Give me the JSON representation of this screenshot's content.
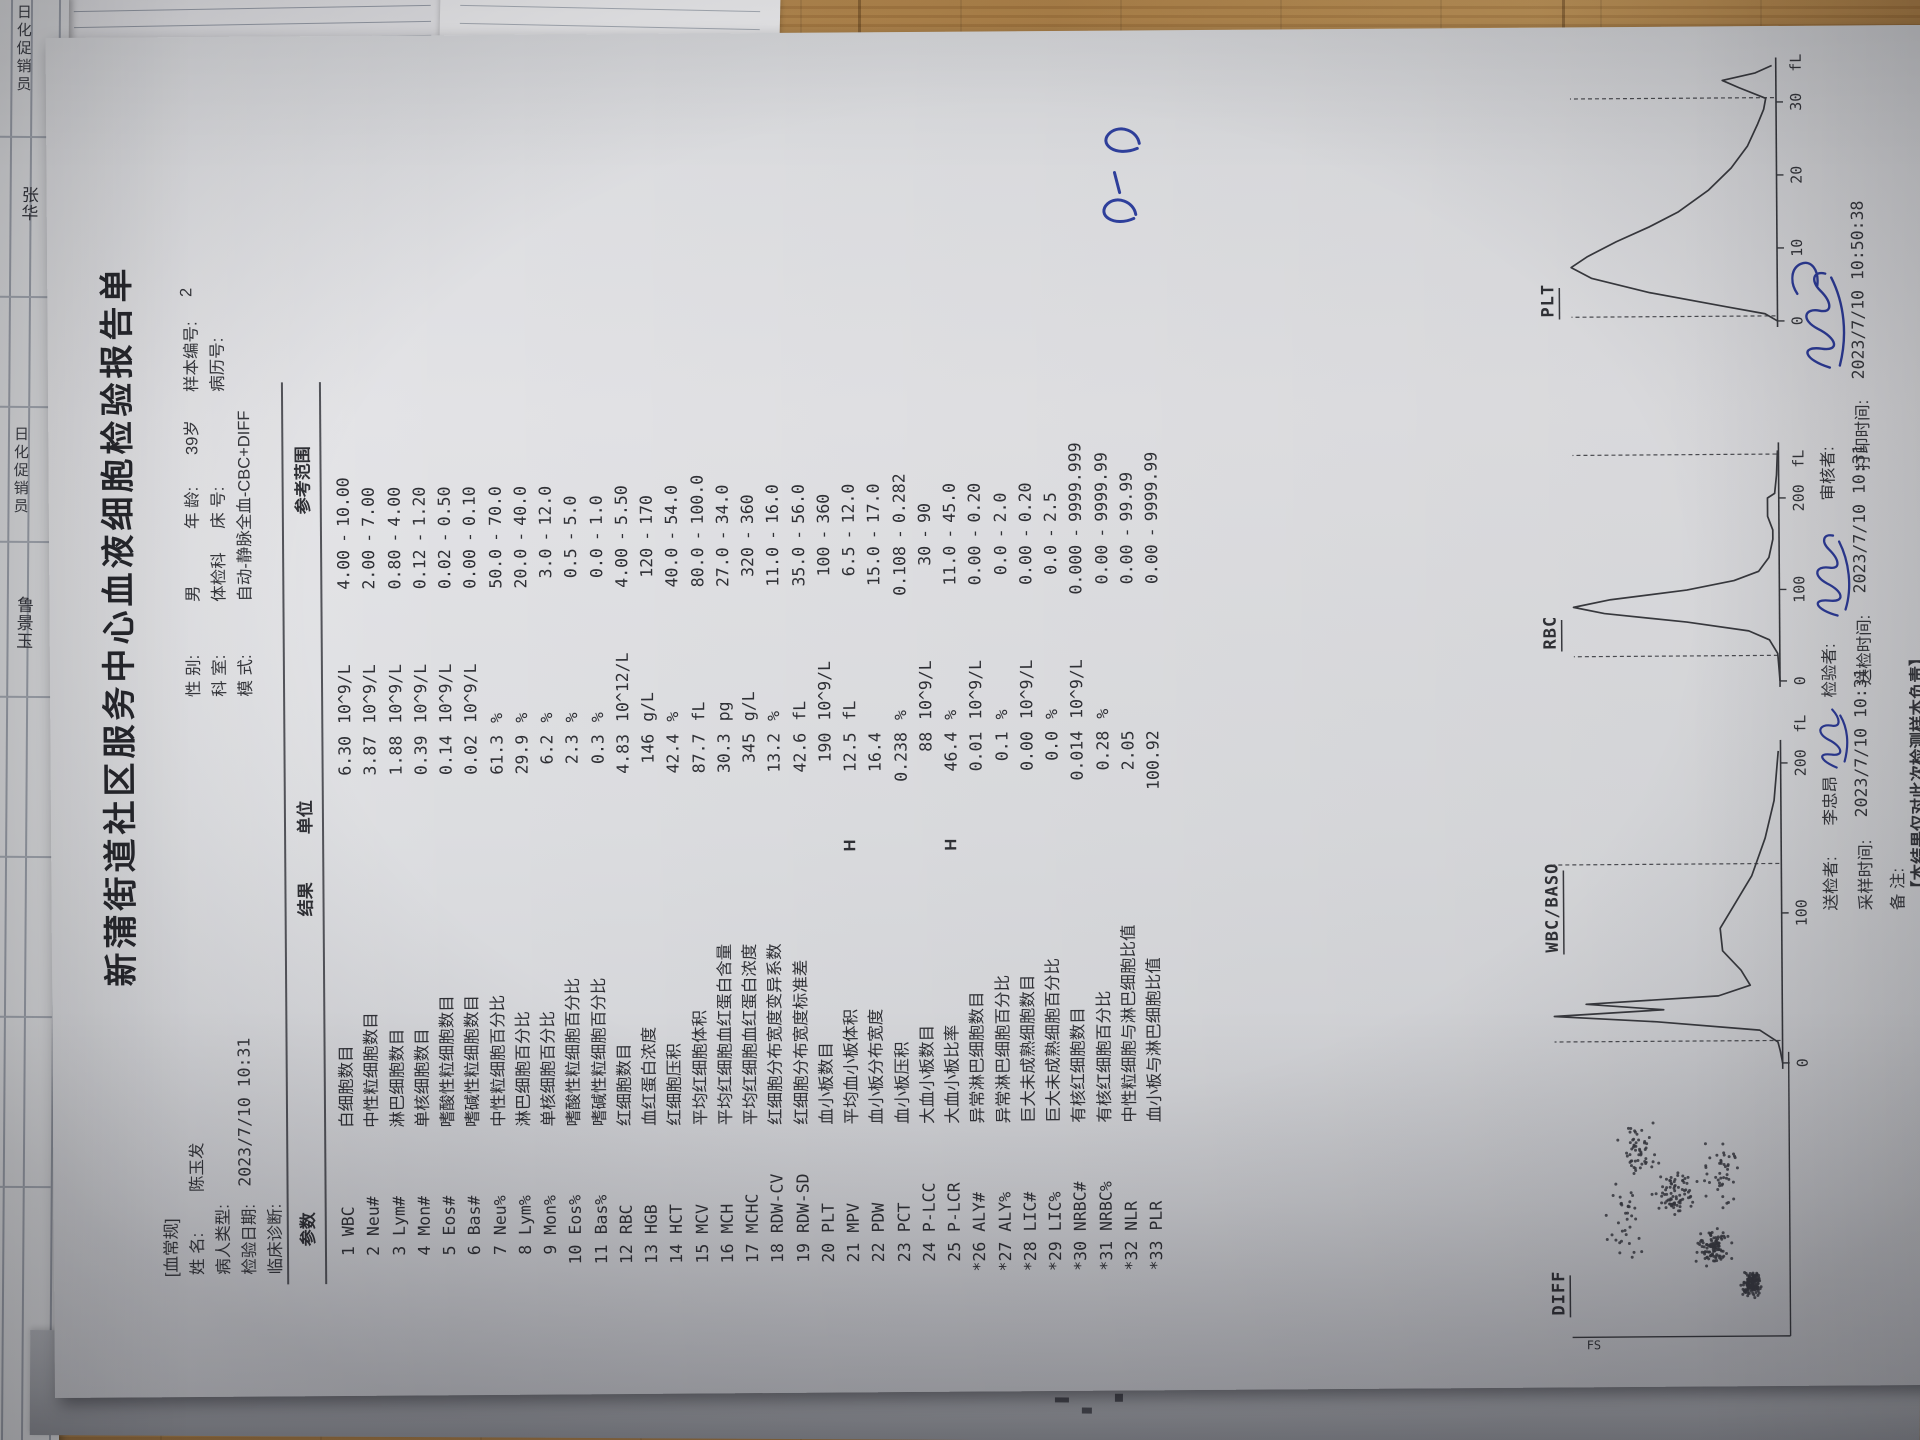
{
  "report": {
    "title": "新蒲街道社区服务中心血液细胞检验报告单",
    "section_tag": "[血常规]",
    "info": {
      "name_label": "姓  名:",
      "name": "陈玉发",
      "sex_label": "性  别:",
      "sex": "男",
      "age_label": "年  龄:",
      "age": "39岁",
      "sample_no_label": "样本编号:",
      "sample_no": "2",
      "patient_type_label": "病人类型:",
      "patient_type": "",
      "dept_label": "科  室:",
      "dept": "体检科",
      "bed_label": "床  号:",
      "bed": "",
      "mrn_label": "病历号:",
      "mrn": "",
      "test_date_label": "检验日期:",
      "test_date": "2023/7/10  10:31",
      "mode_label": "模  式:",
      "mode": "自动-静脉全血-CBC+DIFF",
      "diagnosis_label": "临床诊断:",
      "diagnosis": ""
    },
    "table": {
      "headers": {
        "param": "参数",
        "result": "结果",
        "unit": "单位",
        "range": "参考范围"
      },
      "range_sep": "-",
      "rows": [
        {
          "code": "  1 WBC",
          "name": "白细胞数目",
          "flag": "",
          "result": "6.30",
          "unit": "10^9/L",
          "range_lo": "4.00",
          "range_hi": "10.00"
        },
        {
          "code": "  2 Neu#",
          "name": "中性粒细胞数目",
          "flag": "",
          "result": "3.87",
          "unit": "10^9/L",
          "range_lo": "2.00",
          "range_hi": "7.00"
        },
        {
          "code": "  3 Lym#",
          "name": "淋巴细胞数目",
          "flag": "",
          "result": "1.88",
          "unit": "10^9/L",
          "range_lo": "0.80",
          "range_hi": "4.00"
        },
        {
          "code": "  4 Mon#",
          "name": "单核细胞数目",
          "flag": "",
          "result": "0.39",
          "unit": "10^9/L",
          "range_lo": "0.12",
          "range_hi": "1.20"
        },
        {
          "code": "  5 Eos#",
          "name": "嗜酸性粒细胞数目",
          "flag": "",
          "result": "0.14",
          "unit": "10^9/L",
          "range_lo": "0.02",
          "range_hi": "0.50"
        },
        {
          "code": "  6 Bas#",
          "name": "嗜碱性粒细胞数目",
          "flag": "",
          "result": "0.02",
          "unit": "10^9/L",
          "range_lo": "0.00",
          "range_hi": "0.10"
        },
        {
          "code": "  7 Neu%",
          "name": "中性粒细胞百分比",
          "flag": "",
          "result": "61.3",
          "unit": "%",
          "range_lo": "50.0",
          "range_hi": "70.0"
        },
        {
          "code": "  8 Lym%",
          "name": "淋巴细胞百分比",
          "flag": "",
          "result": "29.9",
          "unit": "%",
          "range_lo": "20.0",
          "range_hi": "40.0"
        },
        {
          "code": "  9 Mon%",
          "name": "单核细胞百分比",
          "flag": "",
          "result": "6.2",
          "unit": "%",
          "range_lo": "3.0",
          "range_hi": "12.0"
        },
        {
          "code": " 10 Eos%",
          "name": "嗜酸性粒细胞百分比",
          "flag": "",
          "result": "2.3",
          "unit": "%",
          "range_lo": "0.5",
          "range_hi": "5.0"
        },
        {
          "code": " 11 Bas%",
          "name": "嗜碱性粒细胞百分比",
          "flag": "",
          "result": "0.3",
          "unit": "%",
          "range_lo": "0.0",
          "range_hi": "1.0"
        },
        {
          "code": " 12 RBC",
          "name": "红细胞数目",
          "flag": "",
          "result": "4.83",
          "unit": "10^12/L",
          "range_lo": "4.00",
          "range_hi": "5.50"
        },
        {
          "code": " 13 HGB",
          "name": "血红蛋白浓度",
          "flag": "",
          "result": "146",
          "unit": "g/L",
          "range_lo": "120",
          "range_hi": "170"
        },
        {
          "code": " 14 HCT",
          "name": "红细胞压积",
          "flag": "",
          "result": "42.4",
          "unit": "%",
          "range_lo": "40.0",
          "range_hi": "54.0"
        },
        {
          "code": " 15 MCV",
          "name": "平均红细胞体积",
          "flag": "",
          "result": "87.7",
          "unit": "fL",
          "range_lo": "80.0",
          "range_hi": "100.0"
        },
        {
          "code": " 16 MCH",
          "name": "平均红细胞血红蛋白含量",
          "flag": "",
          "result": "30.3",
          "unit": "pg",
          "range_lo": "27.0",
          "range_hi": "34.0"
        },
        {
          "code": " 17 MCHC",
          "name": "平均红细胞血红蛋白浓度",
          "flag": "",
          "result": "345",
          "unit": "g/L",
          "range_lo": "320",
          "range_hi": "360"
        },
        {
          "code": " 18 RDW-CV",
          "name": "红细胞分布宽度变异系数",
          "flag": "",
          "result": "13.2",
          "unit": "%",
          "range_lo": "11.0",
          "range_hi": "16.0"
        },
        {
          "code": " 19 RDW-SD",
          "name": "红细胞分布宽度标准差",
          "flag": "",
          "result": "42.6",
          "unit": "fL",
          "range_lo": "35.0",
          "range_hi": "56.0"
        },
        {
          "code": " 20 PLT",
          "name": "血小板数目",
          "flag": "",
          "result": "190",
          "unit": "10^9/L",
          "range_lo": "100",
          "range_hi": "360"
        },
        {
          "code": " 21 MPV",
          "name": "平均血小板体积",
          "flag": "H",
          "result": "12.5",
          "unit": "fL",
          "range_lo": "6.5",
          "range_hi": "12.0"
        },
        {
          "code": " 22 PDW",
          "name": "血小板分布宽度",
          "flag": "",
          "result": "16.4",
          "unit": "",
          "range_lo": "15.0",
          "range_hi": "17.0"
        },
        {
          "code": " 23 PCT",
          "name": "血小板压积",
          "flag": "",
          "result": "0.238",
          "unit": "%",
          "range_lo": "0.108",
          "range_hi": "0.282"
        },
        {
          "code": " 24 P-LCC",
          "name": "大血小板数目",
          "flag": "",
          "result": "88",
          "unit": "10^9/L",
          "range_lo": "30",
          "range_hi": "90"
        },
        {
          "code": " 25 P-LCR",
          "name": "大血小板比率",
          "flag": "H",
          "result": "46.4",
          "unit": "%",
          "range_lo": "11.0",
          "range_hi": "45.0"
        },
        {
          "code": "*26 ALY#",
          "name": "异常淋巴细胞数目",
          "flag": "",
          "result": "0.01",
          "unit": "10^9/L",
          "range_lo": "0.00",
          "range_hi": "0.20"
        },
        {
          "code": "*27 ALY%",
          "name": "异常淋巴细胞百分比",
          "flag": "",
          "result": "0.1",
          "unit": "%",
          "range_lo": "0.0",
          "range_hi": "2.0"
        },
        {
          "code": "*28 LIC#",
          "name": "巨大未成熟细胞数目",
          "flag": "",
          "result": "0.00",
          "unit": "10^9/L",
          "range_lo": "0.00",
          "range_hi": "0.20"
        },
        {
          "code": "*29 LIC%",
          "name": "巨大未成熟细胞百分比",
          "flag": "",
          "result": "0.0",
          "unit": "%",
          "range_lo": "0.0",
          "range_hi": "2.5"
        },
        {
          "code": "*30 NRBC#",
          "name": "有核红细胞数目",
          "flag": "",
          "result": "0.014",
          "unit": "10^9/L",
          "range_lo": "0.000",
          "range_hi": "9999.999"
        },
        {
          "code": "*31 NRBC%",
          "name": "有核红细胞百分比",
          "flag": "",
          "result": "0.28",
          "unit": "%",
          "range_lo": "0.00",
          "range_hi": "9999.99"
        },
        {
          "code": "*32 NLR",
          "name": "中性粒细胞与淋巴细胞比值",
          "flag": "",
          "result": "2.05",
          "unit": "",
          "range_lo": "0.00",
          "range_hi": "99.99"
        },
        {
          "code": "*33 PLR",
          "name": "血小板与淋巴细胞比值",
          "flag": "",
          "result": "100.92",
          "unit": "",
          "range_lo": "0.00",
          "range_hi": "9999.99"
        }
      ]
    },
    "footer": {
      "sender_label": "送检者:",
      "sender": "李忠昂",
      "tester_label": "检验者:",
      "reviewer_label": "审核者:",
      "sample_time_label": "采样时间:",
      "sample_time": "2023/7/10  10:31",
      "send_time_label": "送检时间:",
      "send_time": "2023/7/10  10:31",
      "print_time_label": "打印时间:",
      "print_time": "2023/7/10  10:50:38",
      "note_label": "备  注:",
      "disclaimer": "【本结果仅对此次检测样本负责】"
    },
    "handwritten_mark": "5-5"
  },
  "background": {
    "left_form_texts": [
      "日化促销员",
      "张华",
      "日化促销员",
      "鲁景玉"
    ]
  },
  "chart_data": [
    {
      "type": "scatter",
      "title": "DIFF",
      "ylabel": "FS",
      "legend_position": "none",
      "clusters": [
        {
          "n": 150,
          "x": 0.16,
          "y": 0.84,
          "sx": 0.06,
          "sy": 0.06
        },
        {
          "n": 110,
          "x": 0.3,
          "y": 0.66,
          "sx": 0.1,
          "sy": 0.11
        },
        {
          "n": 80,
          "x": 0.5,
          "y": 0.48,
          "sx": 0.12,
          "sy": 0.13
        },
        {
          "n": 55,
          "x": 0.66,
          "y": 0.3,
          "sx": 0.13,
          "sy": 0.11
        },
        {
          "n": 45,
          "x": 0.58,
          "y": 0.7,
          "sx": 0.18,
          "sy": 0.14
        },
        {
          "n": 35,
          "x": 0.4,
          "y": 0.22,
          "sx": 0.2,
          "sy": 0.12
        }
      ]
    },
    {
      "type": "area",
      "title": "WBC/BASO",
      "xlabel": "fL",
      "xticks": [
        0,
        100,
        200
      ],
      "xlim": [
        0,
        210
      ],
      "dashed_x": [
        15,
        133
      ],
      "curve": [
        [
          0,
          0
        ],
        [
          8,
          0.01
        ],
        [
          14,
          0.02
        ],
        [
          22,
          0.1
        ],
        [
          28,
          0.55
        ],
        [
          32,
          1.0
        ],
        [
          36,
          0.52
        ],
        [
          40,
          0.86
        ],
        [
          45,
          0.28
        ],
        [
          52,
          0.14
        ],
        [
          62,
          0.18
        ],
        [
          75,
          0.26
        ],
        [
          90,
          0.27
        ],
        [
          105,
          0.21
        ],
        [
          125,
          0.13
        ],
        [
          150,
          0.07
        ],
        [
          175,
          0.03
        ],
        [
          200,
          0.015
        ],
        [
          208,
          0.01
        ]
      ]
    },
    {
      "type": "area",
      "title": "RBC",
      "xlabel": "fL",
      "xticks": [
        0,
        100,
        200
      ],
      "xlim": [
        0,
        252
      ],
      "dashed_x": [
        28,
        248
      ],
      "curve": [
        [
          0,
          0
        ],
        [
          15,
          0.005
        ],
        [
          30,
          0.01
        ],
        [
          45,
          0.05
        ],
        [
          55,
          0.15
        ],
        [
          65,
          0.45
        ],
        [
          75,
          0.85
        ],
        [
          82,
          1.0
        ],
        [
          90,
          0.82
        ],
        [
          100,
          0.45
        ],
        [
          110,
          0.22
        ],
        [
          120,
          0.1
        ],
        [
          135,
          0.05
        ],
        [
          155,
          0.03
        ],
        [
          165,
          0.03
        ],
        [
          180,
          0.055
        ],
        [
          200,
          0.055
        ],
        [
          205,
          0.02
        ],
        [
          225,
          0.01
        ],
        [
          252,
          0.005
        ]
      ]
    },
    {
      "type": "area",
      "title": "PLT",
      "xlabel": "fL",
      "xticks": [
        0,
        10,
        20,
        30
      ],
      "xlim": [
        0,
        35
      ],
      "dashed_x": [
        0.7,
        30.6
      ],
      "curve": [
        [
          0,
          0
        ],
        [
          1,
          0.06
        ],
        [
          2,
          0.25
        ],
        [
          4,
          0.62
        ],
        [
          6,
          0.9
        ],
        [
          7.5,
          1.0
        ],
        [
          9,
          0.92
        ],
        [
          11,
          0.78
        ],
        [
          13,
          0.62
        ],
        [
          15,
          0.48
        ],
        [
          18,
          0.33
        ],
        [
          21,
          0.22
        ],
        [
          24,
          0.14
        ],
        [
          27,
          0.09
        ],
        [
          29,
          0.06
        ],
        [
          30.5,
          0.05
        ],
        [
          32,
          0.18
        ],
        [
          33,
          0.26
        ],
        [
          34,
          0.1
        ],
        [
          35,
          0.02
        ]
      ]
    }
  ]
}
